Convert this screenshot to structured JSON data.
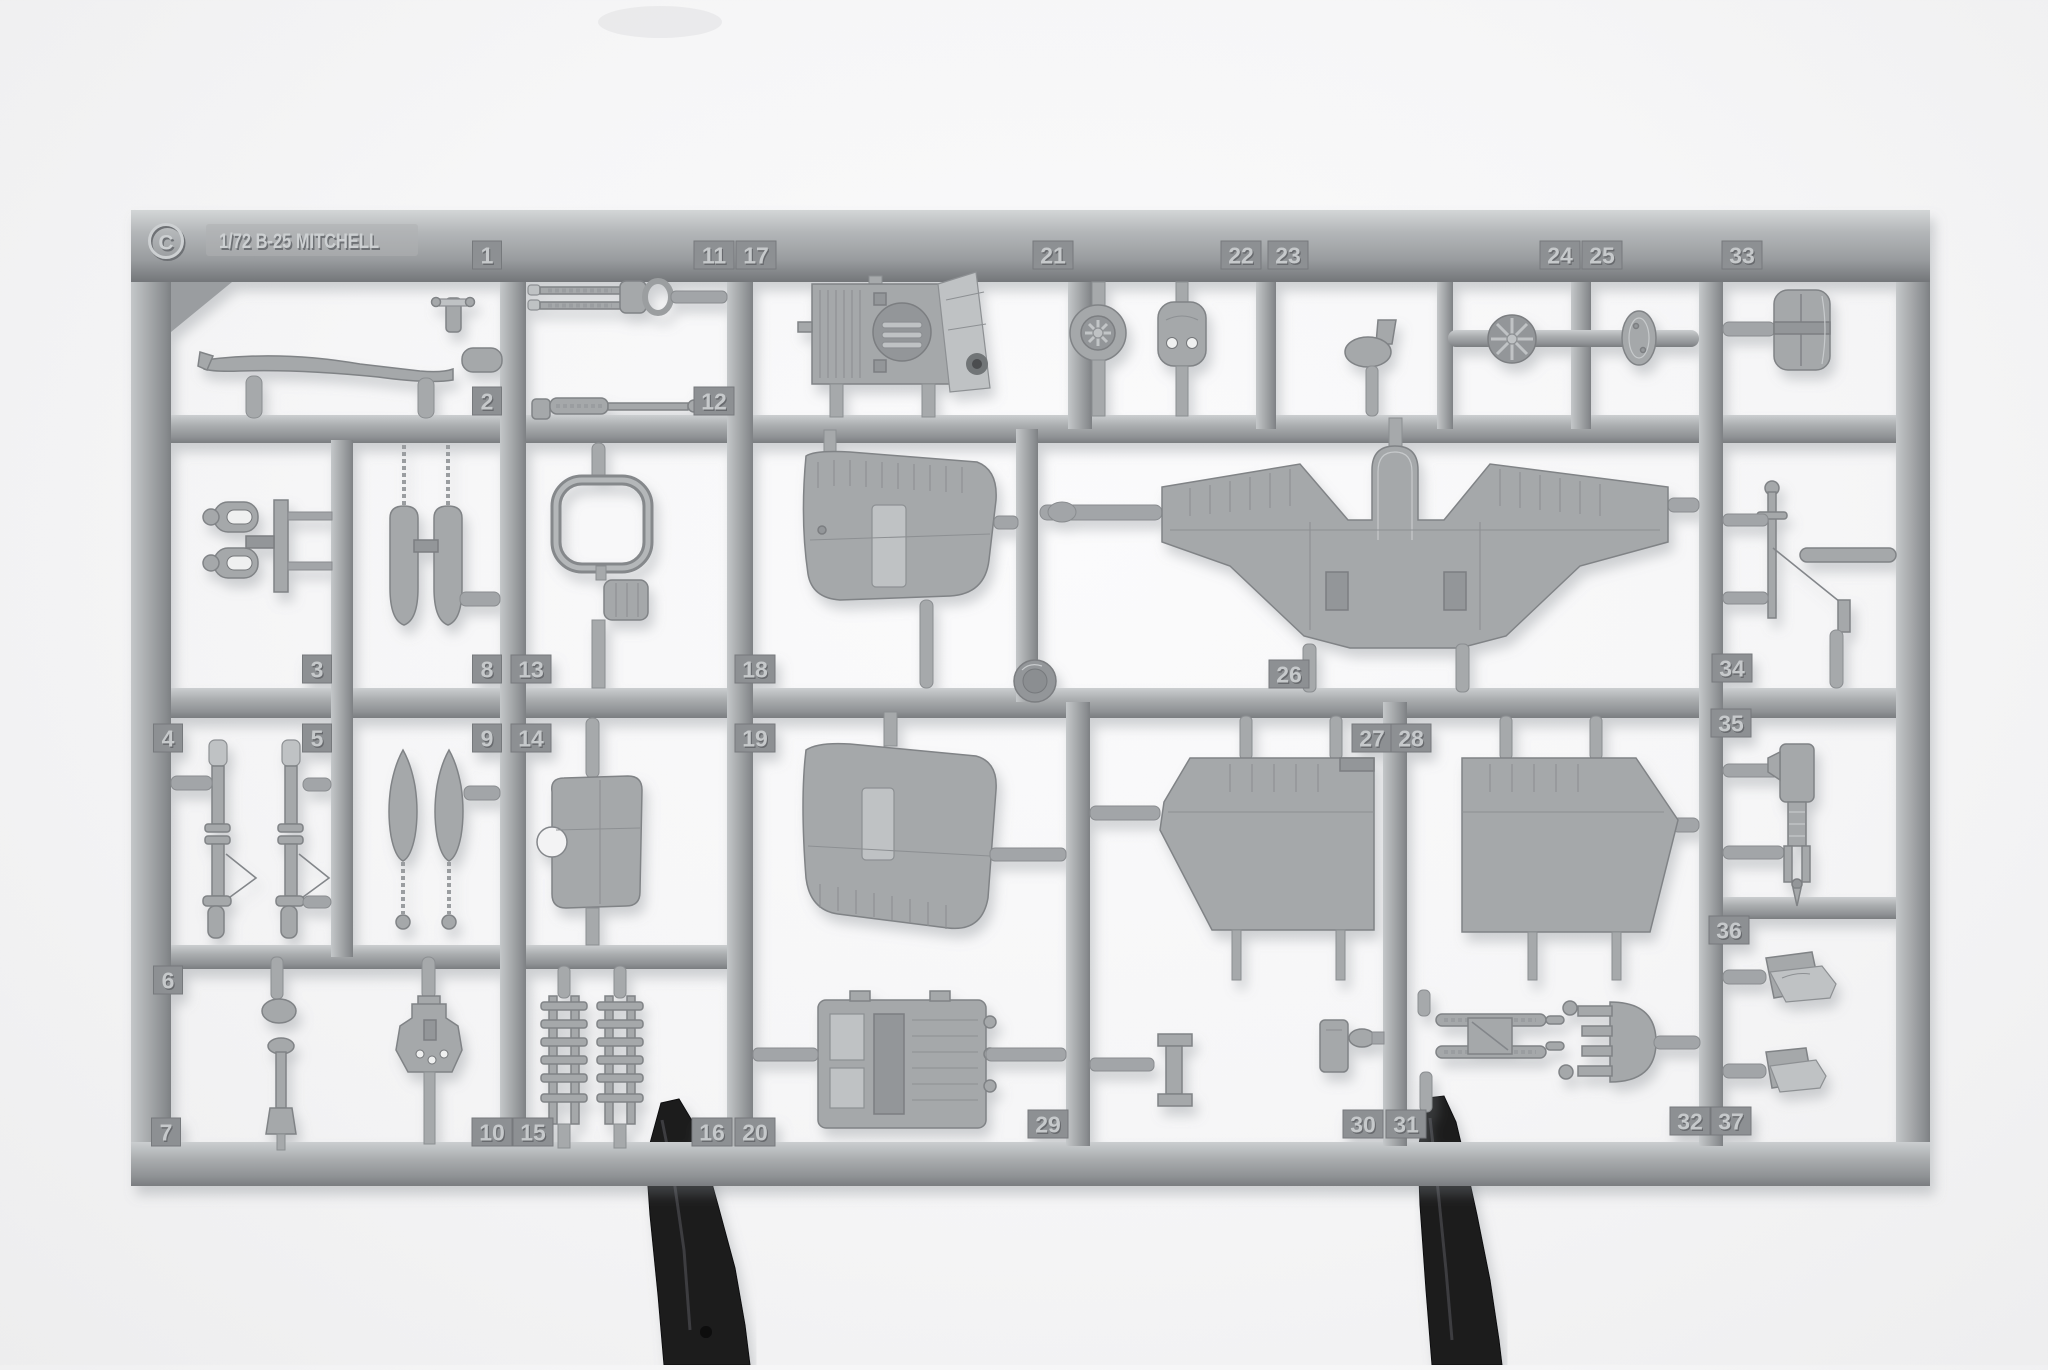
{
  "photo": {
    "subject": "plastic model kit sprue",
    "background": "white seamless studio backdrop",
    "stands": "two black alligator clips holding bottom rail"
  },
  "sprue": {
    "gate_letter": "C",
    "title": "1/72 B-25 MITCHELL",
    "plastic_color_name": "light grey styrene",
    "tabs": [
      {
        "n": "1",
        "x": 487,
        "y": 255
      },
      {
        "n": "2",
        "x": 487,
        "y": 401
      },
      {
        "n": "3",
        "x": 317,
        "y": 669
      },
      {
        "n": "4",
        "x": 168,
        "y": 738
      },
      {
        "n": "5",
        "x": 317,
        "y": 738
      },
      {
        "n": "6",
        "x": 168,
        "y": 980
      },
      {
        "n": "7",
        "x": 166,
        "y": 1132
      },
      {
        "n": "8",
        "x": 487,
        "y": 669
      },
      {
        "n": "9",
        "x": 487,
        "y": 738
      },
      {
        "n": "10",
        "x": 492,
        "y": 1132
      },
      {
        "n": "11",
        "x": 714,
        "y": 255
      },
      {
        "n": "12",
        "x": 714,
        "y": 401
      },
      {
        "n": "13",
        "x": 531,
        "y": 669
      },
      {
        "n": "14",
        "x": 531,
        "y": 738
      },
      {
        "n": "15",
        "x": 533,
        "y": 1132
      },
      {
        "n": "16",
        "x": 712,
        "y": 1132
      },
      {
        "n": "17",
        "x": 756,
        "y": 255
      },
      {
        "n": "18",
        "x": 755,
        "y": 669
      },
      {
        "n": "19",
        "x": 755,
        "y": 738
      },
      {
        "n": "20",
        "x": 755,
        "y": 1132
      },
      {
        "n": "21",
        "x": 1053,
        "y": 255
      },
      {
        "n": "22",
        "x": 1241,
        "y": 255
      },
      {
        "n": "23",
        "x": 1288,
        "y": 255
      },
      {
        "n": "24",
        "x": 1560,
        "y": 255
      },
      {
        "n": "25",
        "x": 1602,
        "y": 255
      },
      {
        "n": "26",
        "x": 1289,
        "y": 674
      },
      {
        "n": "27",
        "x": 1372,
        "y": 738
      },
      {
        "n": "28",
        "x": 1411,
        "y": 738
      },
      {
        "n": "29",
        "x": 1048,
        "y": 1124
      },
      {
        "n": "30",
        "x": 1363,
        "y": 1124
      },
      {
        "n": "31",
        "x": 1406,
        "y": 1124
      },
      {
        "n": "32",
        "x": 1690,
        "y": 1121
      },
      {
        "n": "33",
        "x": 1742,
        "y": 255
      },
      {
        "n": "34",
        "x": 1732,
        "y": 668
      },
      {
        "n": "35",
        "x": 1731,
        "y": 723
      },
      {
        "n": "36",
        "x": 1729,
        "y": 930
      },
      {
        "n": "37",
        "x": 1731,
        "y": 1121
      }
    ],
    "parts": [
      {
        "num": "1",
        "name": "valve-fitting"
      },
      {
        "num": "2",
        "name": "antenna-rod"
      },
      {
        "num": "3",
        "name": "gun-yoke-mounts"
      },
      {
        "num": "4",
        "name": "flexible-gun-barrel"
      },
      {
        "num": "5",
        "name": "flexible-gun-barrel"
      },
      {
        "num": "6",
        "name": "oval-fairing"
      },
      {
        "num": "7",
        "name": "control-column"
      },
      {
        "num": "8",
        "name": "bomb-halves"
      },
      {
        "num": "9",
        "name": "bombs-with-fuze-rods"
      },
      {
        "num": "10",
        "name": "gun-mount"
      },
      {
        "num": "11",
        "name": "twin-machine-gun"
      },
      {
        "num": "12",
        "name": "machine-gun"
      },
      {
        "num": "13",
        "name": "window-frame"
      },
      {
        "num": "14",
        "name": "hatch-panel"
      },
      {
        "num": "15",
        "name": "bomb-rack"
      },
      {
        "num": "16",
        "name": "bomb-rack"
      },
      {
        "num": "17",
        "name": "louvered-equipment-box"
      },
      {
        "num": "18",
        "name": "fuselage-skin-panel"
      },
      {
        "num": "19",
        "name": "fuselage-skin-panel"
      },
      {
        "num": "20",
        "name": "bomb-bay-door"
      },
      {
        "num": "21",
        "name": "wheel"
      },
      {
        "num": "22",
        "name": "cowl-plate"
      },
      {
        "num": "23",
        "name": "carburetor-intake"
      },
      {
        "num": "24",
        "name": "engine-fan"
      },
      {
        "num": "25",
        "name": "bulkhead-disc"
      },
      {
        "num": "26",
        "name": "wing-centre-section"
      },
      {
        "num": "27",
        "name": "outer-wing-panel"
      },
      {
        "num": "28",
        "name": "outer-wing-panel"
      },
      {
        "num": "29",
        "name": "pylon-bracket"
      },
      {
        "num": "30",
        "name": "gear-bracket"
      },
      {
        "num": "31",
        "name": "gun-pack-rails"
      },
      {
        "num": "32",
        "name": "flare-rack"
      },
      {
        "num": "33",
        "name": "armored-seat-back"
      },
      {
        "num": "34",
        "name": "antenna-mast"
      },
      {
        "num": "35",
        "name": "tail-gear-strut"
      },
      {
        "num": "36",
        "name": "crew-seat"
      },
      {
        "num": "37",
        "name": "crew-seat"
      }
    ]
  },
  "colors": {
    "background": "#f6f6f7",
    "plastic_mid": "#a7aaac",
    "plastic_light": "#cbced0",
    "plastic_dark": "#87898c",
    "tab_fill": "#8d9093",
    "embossed_text": "#cdd0d2",
    "clip_black": "#1b1b1d"
  }
}
